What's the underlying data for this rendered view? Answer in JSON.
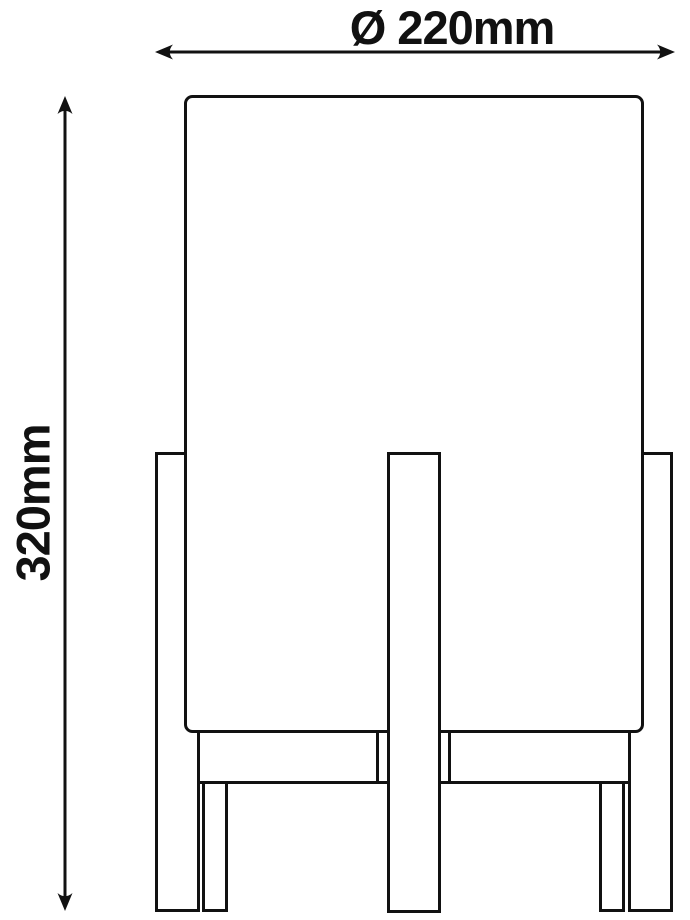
{
  "drawing": {
    "name": "table-lamp-dimension-drawing",
    "diameter_label": "Ø 220mm",
    "height_label": "320mm",
    "line_color": "#111111",
    "background_color": "#ffffff"
  }
}
